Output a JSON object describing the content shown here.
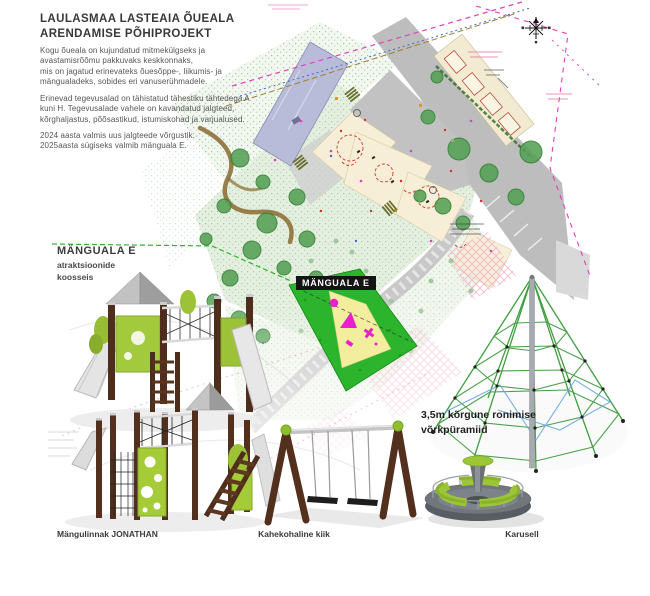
{
  "header": {
    "title": "LAULASMAA LASTEAIA ÕUEALA\nARENDAMISE PÕHIPROJEKT",
    "paragraph1": "Kogu õueala on kujundatud mitmekülgseks ja\navastamisrõõmu pakkuvaks keskkonnaks,\nmis on jagatud erinevateks õuesõppe-, liikumis- ja\nmängualadeks, sobides eri vanuserühmadele.",
    "paragraph2": "Erinevad tegevusalad on tähistatud tähestiku tähtedega A\nkuni H. Tegevusalade vahele on kavandatud jalgteed,\nkõrghaljastus, põõsastikud, istumiskohad ja varjualused.",
    "paragraph3": "2024 aasta valmis uus jalgteede võrgustik.\n2025aasta sügiseks valmib mänguala E."
  },
  "play_area": {
    "name": "MÄNGUALA E",
    "subtitle": "atraktsioonide\nkoosseis",
    "map_label": "MÄNGUALA E"
  },
  "equipment": {
    "pyramid_note": "3,5m kõrgune ronimise\nvõrkpüramiid",
    "items": [
      {
        "name": "Mängulinnak JONATHAN"
      },
      {
        "name": "Kahekohaline kiik"
      },
      {
        "name": "Karusell"
      }
    ]
  },
  "icons": {
    "north_arrow": "compass-rose"
  },
  "colors": {
    "highlight_green": "#2cb52c",
    "map_label_bg": "#141414",
    "equipment_green": "#9cc636",
    "wood_brown": "#53301d",
    "magenta": "#ea1fd0",
    "building_lavender": "#b8bcd8"
  }
}
